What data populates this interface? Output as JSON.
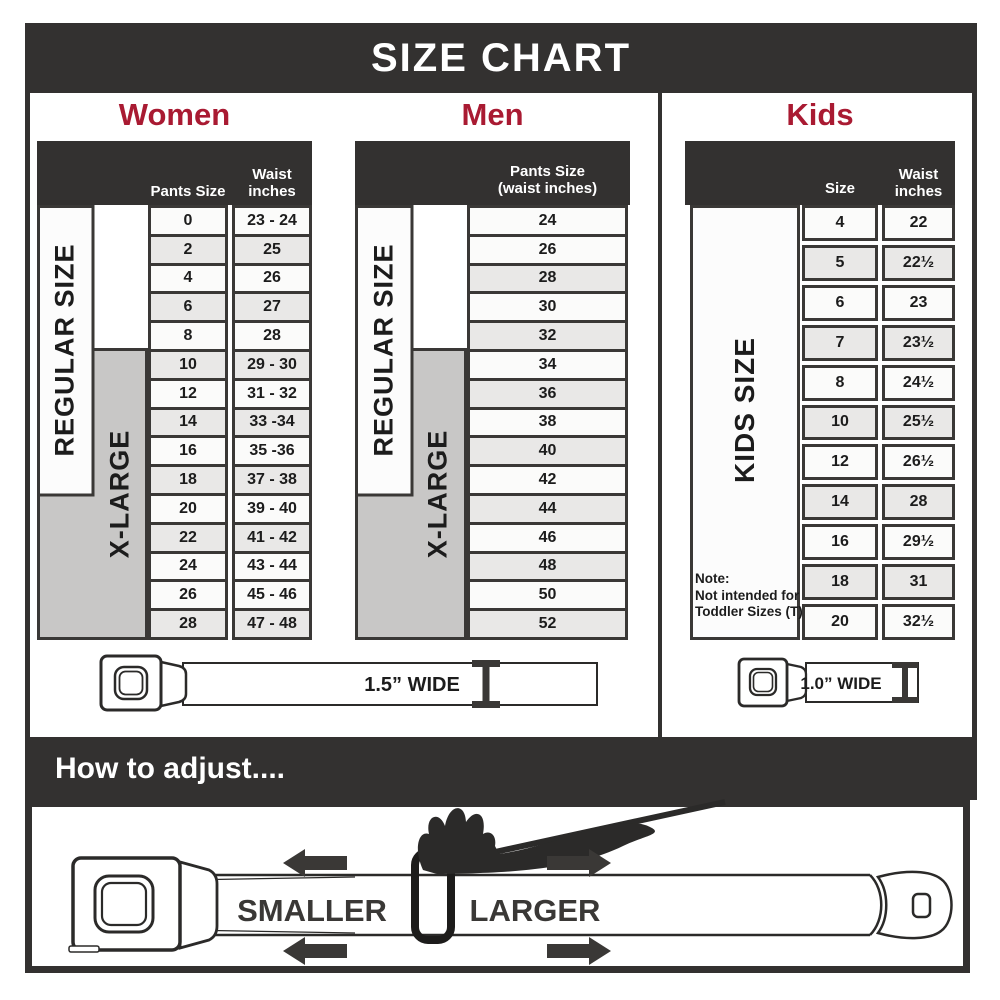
{
  "page": {
    "title": "SIZE CHART"
  },
  "colors": {
    "dark": "#333130",
    "accent_red": "#a91a32",
    "row_light": "#fbfbfa",
    "row_shaded": "#e9e8e7",
    "xlarge_gray": "#c8c7c6"
  },
  "women": {
    "title": "Women",
    "col1_header": "Pants Size",
    "col2_header_line1": "Waist",
    "col2_header_line2": "inches",
    "regular_label": "REGULAR SIZE",
    "xlarge_label": "X-LARGE",
    "rows": [
      {
        "size": "0",
        "waist": "23 - 24",
        "shaded": false
      },
      {
        "size": "2",
        "waist": "25",
        "shaded": true
      },
      {
        "size": "4",
        "waist": "26",
        "shaded": false
      },
      {
        "size": "6",
        "waist": "27",
        "shaded": true
      },
      {
        "size": "8",
        "waist": "28",
        "shaded": false
      },
      {
        "size": "10",
        "waist": "29 - 30",
        "shaded": true
      },
      {
        "size": "12",
        "waist": "31 - 32",
        "shaded": false
      },
      {
        "size": "14",
        "waist": "33 -34",
        "shaded": true
      },
      {
        "size": "16",
        "waist": "35 -36",
        "shaded": false
      },
      {
        "size": "18",
        "waist": "37 - 38",
        "shaded": true
      },
      {
        "size": "20",
        "waist": "39 - 40",
        "shaded": false
      },
      {
        "size": "22",
        "waist": "41 - 42",
        "shaded": true
      },
      {
        "size": "24",
        "waist": "43 - 44",
        "shaded": false
      },
      {
        "size": "26",
        "waist": "45 - 46",
        "shaded": false
      },
      {
        "size": "28",
        "waist": "47 - 48",
        "shaded": true
      }
    ]
  },
  "men": {
    "title": "Men",
    "col_header_line1": "Pants Size",
    "col_header_line2": "(waist inches)",
    "regular_label": "REGULAR SIZE",
    "xlarge_label": "X-LARGE",
    "rows": [
      {
        "size": "24",
        "shaded": false
      },
      {
        "size": "26",
        "shaded": false
      },
      {
        "size": "28",
        "shaded": true
      },
      {
        "size": "30",
        "shaded": false
      },
      {
        "size": "32",
        "shaded": true
      },
      {
        "size": "34",
        "shaded": false
      },
      {
        "size": "36",
        "shaded": true
      },
      {
        "size": "38",
        "shaded": false
      },
      {
        "size": "40",
        "shaded": true
      },
      {
        "size": "42",
        "shaded": false
      },
      {
        "size": "44",
        "shaded": true
      },
      {
        "size": "46",
        "shaded": false
      },
      {
        "size": "48",
        "shaded": true
      },
      {
        "size": "50",
        "shaded": false
      },
      {
        "size": "52",
        "shaded": true
      }
    ]
  },
  "kids": {
    "title": "Kids",
    "col1_header": "Size",
    "col2_header_line1": "Waist",
    "col2_header_line2": "inches",
    "side_label": "KIDS SIZE",
    "note_lines": [
      "Note:",
      "Not intended for",
      "Toddler Sizes (T)"
    ],
    "rows": [
      {
        "size": "4",
        "waist": "22",
        "shaded": false
      },
      {
        "size": "5",
        "waist": "22½",
        "shaded": true
      },
      {
        "size": "6",
        "waist": "23",
        "shaded": false
      },
      {
        "size": "7",
        "waist": "23½",
        "shaded": true
      },
      {
        "size": "8",
        "waist": "24½",
        "shaded": false
      },
      {
        "size": "10",
        "waist": "25½",
        "shaded": true
      },
      {
        "size": "12",
        "waist": "26½",
        "shaded": false
      },
      {
        "size": "14",
        "waist": "28",
        "shaded": true
      },
      {
        "size": "16",
        "waist": "29½",
        "shaded": false
      },
      {
        "size": "18",
        "waist": "31",
        "shaded": true
      },
      {
        "size": "20",
        "waist": "32½",
        "shaded": false
      }
    ]
  },
  "belts": {
    "adult_width_label": "1.5” WIDE",
    "kids_width_label": "1.0” WIDE"
  },
  "adjust": {
    "heading": "How to adjust....",
    "smaller_label": "SMALLER",
    "larger_label": "LARGER"
  }
}
